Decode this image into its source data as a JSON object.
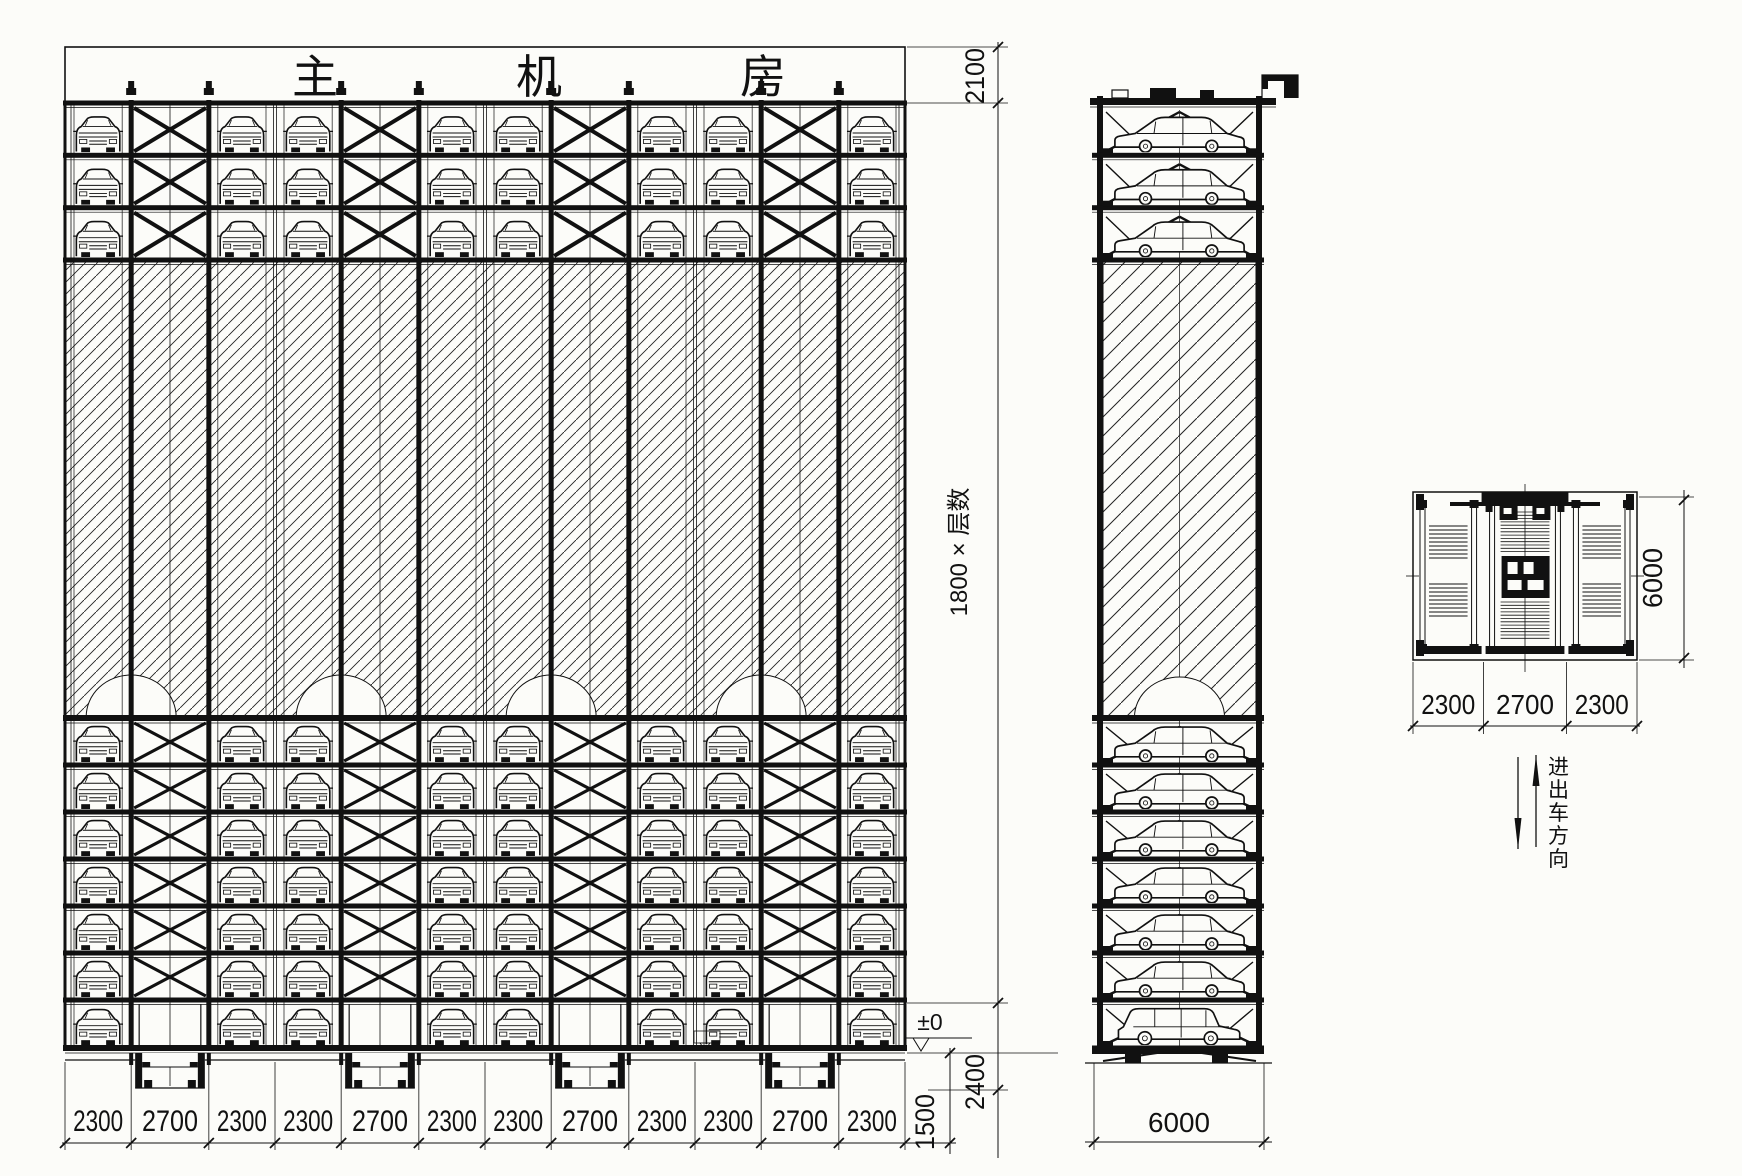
{
  "drawing": {
    "type": "mechanical-parking-system-elevation",
    "line_color": "#111111",
    "paper_color": "#fcfcf9"
  },
  "front_elevation": {
    "machine_room_label": "主机房",
    "bay_dims_mm": [
      "2300",
      "2700",
      "2300",
      "2300",
      "2700",
      "2300",
      "2300",
      "2700",
      "2300",
      "2300",
      "2700",
      "2300"
    ],
    "upper_levels": 3,
    "lower_levels": 7,
    "dims": {
      "machine_room_height": "2100",
      "floor_height_formula": "1800 × 层数",
      "ground_level": "±0",
      "base_height": "2400",
      "pit_dim": "1500"
    }
  },
  "side_elevation": {
    "depth_dim": "6000",
    "upper_levels": 3,
    "lower_levels": 7
  },
  "plan_view": {
    "bay_dims_mm": [
      "2300",
      "2700",
      "2300"
    ],
    "depth_dim": "6000",
    "direction_label": "进出车方向"
  }
}
